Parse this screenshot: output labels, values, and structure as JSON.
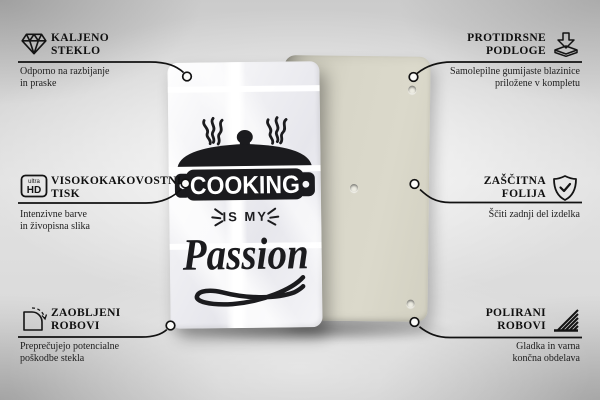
{
  "colors": {
    "ink": "#1b1b1e",
    "line": "#121212",
    "front_panel": "#f3f3f5",
    "back_panel": "#d8d6c8",
    "background_mid": "#dadada"
  },
  "artwork": {
    "word_top": "COOKING",
    "word_mid": "IS MY",
    "word_script": "Passion"
  },
  "hd_icon": {
    "line1": "ultra",
    "line2": "HD"
  },
  "features": [
    {
      "id": "tempered-glass",
      "icon": "diamond-icon",
      "title1": "KALJENO",
      "title2": "STEKLO",
      "desc1": "Odporno na razbijanje",
      "desc2": "in praske"
    },
    {
      "id": "anti-slip-pads",
      "icon": "pads-arrow-icon",
      "title1": "PROTIDRSNE",
      "title2": "PODLOGE",
      "desc1": "Samolepilne gumijaste blazinice",
      "desc2": "priložene v kompletu"
    },
    {
      "id": "high-quality-print",
      "icon": "ultra-hd-icon",
      "title1": "VISOKOKAKOVOSTNI",
      "title2": "TISK",
      "desc1": "Intenzivne barve",
      "desc2": "in živopisna slika"
    },
    {
      "id": "protective-film",
      "icon": "shield-check-icon",
      "title1": "ZAŠČITNA",
      "title2": "FOLIJA",
      "desc1": "Ščiti zadnji del izdelka",
      "desc2": ""
    },
    {
      "id": "rounded-corners",
      "icon": "rounded-corner-icon",
      "title1": "ZAOBLJENI",
      "title2": "ROBOVI",
      "desc1": "Preprečujejo potencialne",
      "desc2": "poškodbe stekla"
    },
    {
      "id": "polished-edges",
      "icon": "hatched-edge-icon",
      "title1": "POLIRANI",
      "title2": "ROBOVI",
      "desc1": "Gladka in varna",
      "desc2": "končna obdelava"
    }
  ]
}
